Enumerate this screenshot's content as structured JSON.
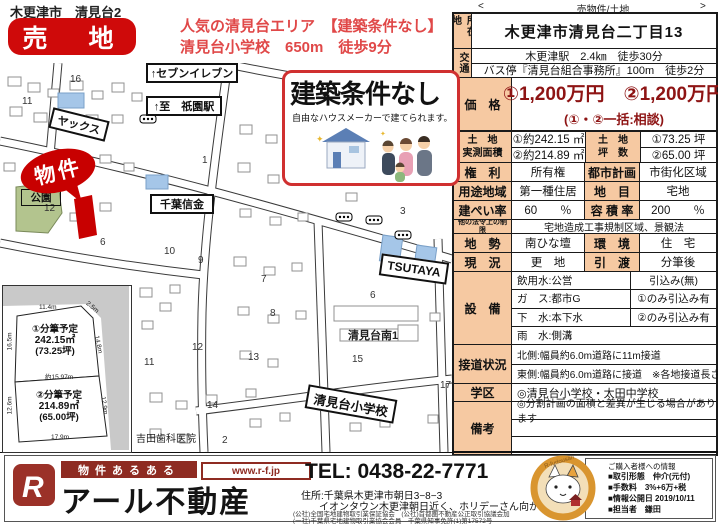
{
  "header": {
    "area_label": "木更津市　清見台2",
    "badge": "売　地",
    "promo_line1": "人気の清見台エリア　【建築条件なし】",
    "promo_line2": "清見台小学校　650m　徒歩9分",
    "nav_prev": "<",
    "nav_category": "売物件/土地",
    "nav_next": ">"
  },
  "details": {
    "location_label": "所在地",
    "location": "木更津市清見台二丁目13",
    "access_label": "交通",
    "access_line1": "木更津駅　2.4㎞　徒歩30分",
    "access_line2": "バス停『清見台組合事務所』100m　徒歩2分",
    "price_label": "価　格",
    "price_line1": "①1,200万円　②1,200万円",
    "price_line2": "(①・②一括:相談)",
    "land_area_label1": "土　地",
    "land_area_label2": "実測面積",
    "land_area_1": "①約242.15 ㎡",
    "land_area_2": "②約214.89 ㎡",
    "tsubo_label1": "土　地",
    "tsubo_label2": "坪　数",
    "tsubo_1": "①73.25 坪",
    "tsubo_2": "②65.00 坪",
    "rights_label": "権　利",
    "rights": "所有権",
    "city_plan_label": "都市計画",
    "city_plan": "市街化区域",
    "zoning_label": "用途地域",
    "zoning": "第一種住居",
    "land_cat_label": "地　目",
    "land_cat": "宅地",
    "coverage_label": "建ぺい率",
    "coverage": "60　　％",
    "far_label": "容 積 率",
    "far": "200　　％",
    "other_laws_label": "他の法令上の制限",
    "other_laws": "宅地造成工事規制区域、景観法",
    "terrain_label": "地　勢",
    "terrain": "南ひな壇",
    "environment_label": "環　境",
    "environment": "住　宅",
    "status_label": "現　況",
    "status": "更　地",
    "handover_label": "引　渡",
    "handover": "分筆後",
    "utilities_label": "設　備",
    "util_water": "飲用水:公営",
    "util_water_note": "引込み(無)",
    "util_gas": "ガ　ス:都市G",
    "util_gas_note": "①のみ引込み有",
    "util_sewer": "下　水:本下水",
    "util_sewer_note": "②のみ引込み有",
    "util_rain": "雨　水:側溝",
    "road_label": "接道状況",
    "road_line1": "北側:幅員約6.0m道路に11m接道",
    "road_line2": "東側:幅員約6.0m道路に接道　※各地接道長さ参照",
    "school_label": "学区",
    "school": "◎清見台小学校・太田中学校",
    "notes_label": "備考",
    "notes": "◎分割計画の面積と差異が生じる場合があります"
  },
  "map": {
    "labels": {
      "seven_eleven": "↑セブンイレブン",
      "gion_station": "↑至　祇園駅",
      "yax": "ヤックス",
      "property": "物件",
      "park": "公園",
      "chiba_shinkin": "千葉信金",
      "tsutaya": "TSUTAYA",
      "kiyomidai_minami": "清見台南1",
      "elementary_school": "清見台小学校",
      "dental_clinic": "・吉田歯科医院"
    },
    "block_numbers": [
      "16",
      "11",
      "1",
      "12",
      "6",
      "10",
      "9",
      "3",
      "7",
      "6",
      "8",
      "12",
      "13",
      "11",
      "14",
      "15",
      "17",
      "2"
    ],
    "callout": {
      "title": "建築条件なし",
      "subtitle": "自由なハウスメーカーで建てられます。"
    },
    "lot_diagram": {
      "lot1_title": "①分筆予定",
      "lot1_area": "242.15㎡",
      "lot1_tsubo": "(73.25坪)",
      "lot2_title": "②分筆予定",
      "lot2_area": "214.89㎡",
      "lot2_tsubo": "(65.00坪)",
      "dim_top": "11.4m",
      "dim_corner": "2.5m",
      "dim_left1": "16.5m",
      "dim_right1": "14.8m",
      "dim_middle": "約15.97m",
      "dim_left2": "12.6m",
      "dim_right2": "12.9m",
      "dim_bottom": "17.9m"
    }
  },
  "footer": {
    "logo_letter": "R",
    "tagline": "物件あるある",
    "url": "www.r-f.jp",
    "company": "アール不動産",
    "tel": "TEL: 0438-22-7771",
    "addr1": "住所:千葉県木更津市朝日3−8−3",
    "addr2": "イオンタウン木更津朝日近く、ホリデーさん向かい",
    "assoc1": "(公社)全国宅地建物取引業保証協会　(公社)首都圏不動産公正取引協議会加",
    "assoc2": "(一社)千葉県宅地建物取引業協会会員　千葉県知事免許(1)第17572号",
    "mascot_text": "R-fudousan",
    "info_title": "ご購入者様への情報",
    "info_line1": "■取引形態　仲介(元付)",
    "info_line2": "■手数料　3%+6万+税",
    "info_line3": "■情報公開日 2019/10/11",
    "info_line4": "■担当者　鎌田"
  }
}
